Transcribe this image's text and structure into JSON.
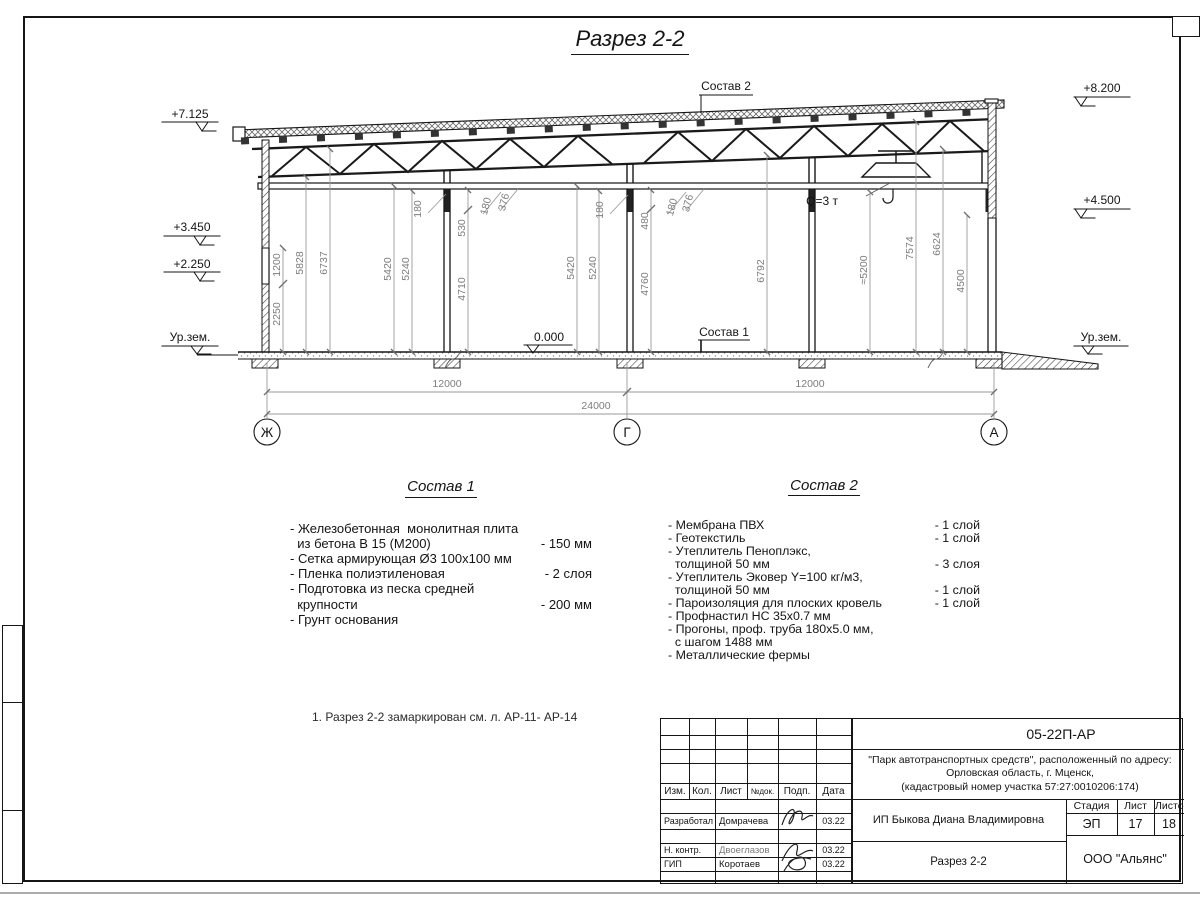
{
  "sheet_title": "Разрез 2-2",
  "drawing": {
    "elev": {
      "top_left": "+7.125",
      "mid_left": "+3.450",
      "low_left": "+2.250",
      "ground": "Ур.зем.",
      "zero": "0.000",
      "top_right": "+8.200",
      "mid_right": "+4.500"
    },
    "callouts": {
      "c1": "Состав 1",
      "c2": "Состав 2",
      "crane": "Q=3 т"
    },
    "dims": {
      "v": [
        "2250",
        "1200",
        "5828",
        "6737",
        "5420",
        "5240",
        "180",
        "530",
        "4710",
        "180",
        "376",
        "5420",
        "5240",
        "180",
        "480",
        "4760",
        "180",
        "376",
        "6792",
        "≈5200",
        "7574",
        "6624",
        "4500"
      ],
      "h": [
        "12000",
        "12000",
        "24000"
      ]
    },
    "axes": [
      "Ж",
      "Г",
      "А"
    ]
  },
  "materials1": {
    "title": "Состав 1",
    "items": [
      {
        "text": "- Железобетонная  монолитная плита\n  из бетона В 15 (М200)",
        "value": "- 150 мм"
      },
      {
        "text": "- Сетка армирующая Ø3 100х100 мм",
        "value": ""
      },
      {
        "text": "- Пленка полиэтиленовая",
        "value": "-  2 слоя"
      },
      {
        "text": "- Подготовка из песка средней\n  крупности",
        "value": "- 200 мм"
      },
      {
        "text": "- Грунт основания",
        "value": ""
      }
    ]
  },
  "materials2": {
    "title": "Состав 2",
    "items": [
      {
        "text": "- Мембрана ПВХ",
        "value": "- 1 слой"
      },
      {
        "text": "- Геотекстиль",
        "value": "- 1 слой"
      },
      {
        "text": "- Утеплитель Пеноплэкс,\n  толщиной 50 мм",
        "value": "- 3 слоя"
      },
      {
        "text": "- Утеплитель Эковер Y=100 кг/м3,\n  толщиной 50 мм",
        "value": "- 1 слой"
      },
      {
        "text": "- Пароизоляция для плоских кровель",
        "value": "- 1 слой"
      },
      {
        "text": "- Профнастил НС 35х0.7 мм",
        "value": ""
      },
      {
        "text": "- Прогоны, проф. труба 180х5.0 мм,\n  с шагом 1488 мм",
        "value": ""
      },
      {
        "text": "- Металлические фермы",
        "value": ""
      }
    ]
  },
  "note": "1. Разрез 2-2 замаркирован см. л. АР-11- АР-14",
  "titleblock": {
    "code": "05-22П-АР",
    "project": "\"Парк автотранспортных средств\",  расположенный по адресу:\nОрловская область, г. Мценск,\n(кадастровый номер участка 57:27:0010206:174)",
    "cols": {
      "izm": "Изм.",
      "kol": "Кол.",
      "list": "Лист",
      "ndok": "№док.",
      "podp": "Подп.",
      "data": "Дата"
    },
    "rows": [
      {
        "role": "Разработал",
        "name": "Домрачева",
        "date": "03.22"
      },
      {
        "role": "Н. контр.",
        "name": "Двоеглазов",
        "date": "03.22"
      },
      {
        "role": "ГИП",
        "name": "Коротаев",
        "date": "03.22"
      }
    ],
    "client": "ИП Быкова Диана Владимировна",
    "drawing_name": "Разрез 2-2",
    "stage_label": "Стадия",
    "list_label": "Лист",
    "listov_label": "Листов",
    "stage": "ЭП",
    "list_num": "17",
    "listov_num": "18",
    "org": "ООО \"Альянс\""
  }
}
